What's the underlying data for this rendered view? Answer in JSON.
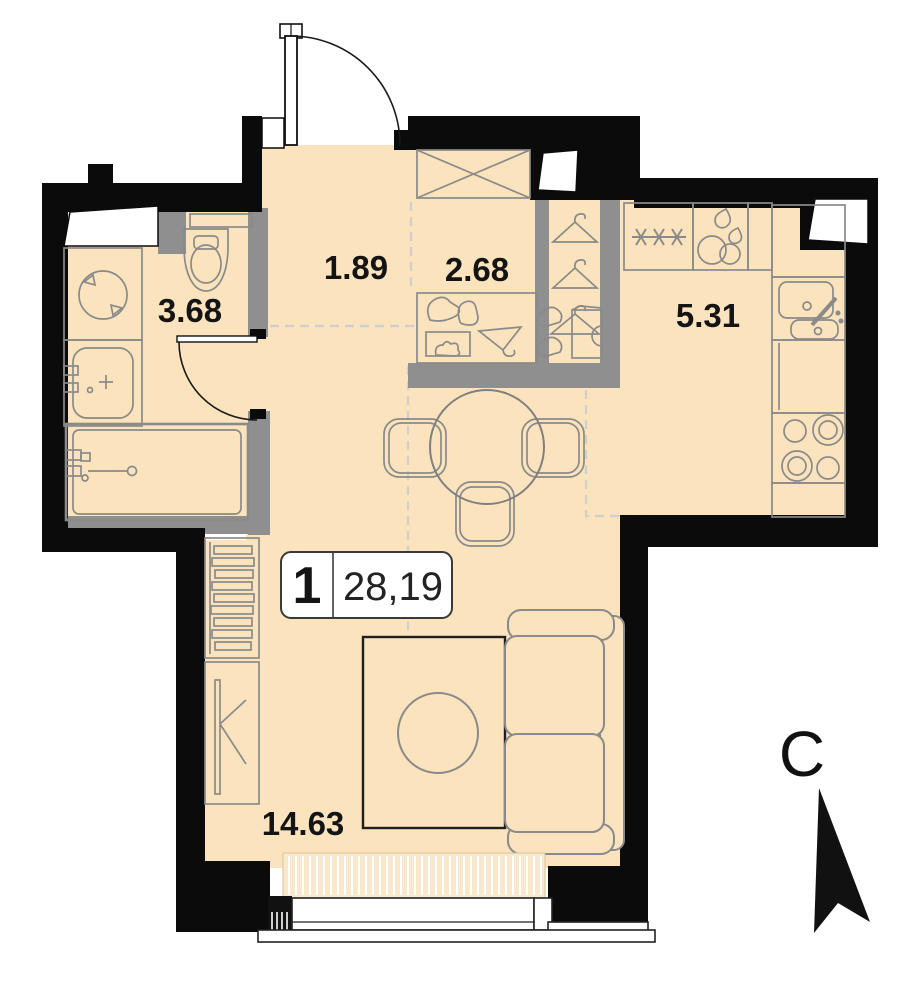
{
  "title": "Apartment floor plan",
  "plan": {
    "badge": {
      "rooms_count": "1",
      "total_area": "28,19"
    },
    "rooms": {
      "bathroom_area": "3.68",
      "hallway_area": "1.89",
      "closet_area": "2.68",
      "kitchen_area": "5.31",
      "living_area": "14.63"
    },
    "compass": {
      "north_label": "С"
    },
    "colors": {
      "floor": "#FAE3BD",
      "walls": "#0B0B0B",
      "partitions": "#8F8F8F",
      "furniture_outline": "#8A8A8A",
      "zone_dash": "#CFCFCF",
      "label_text": "#141414"
    }
  }
}
